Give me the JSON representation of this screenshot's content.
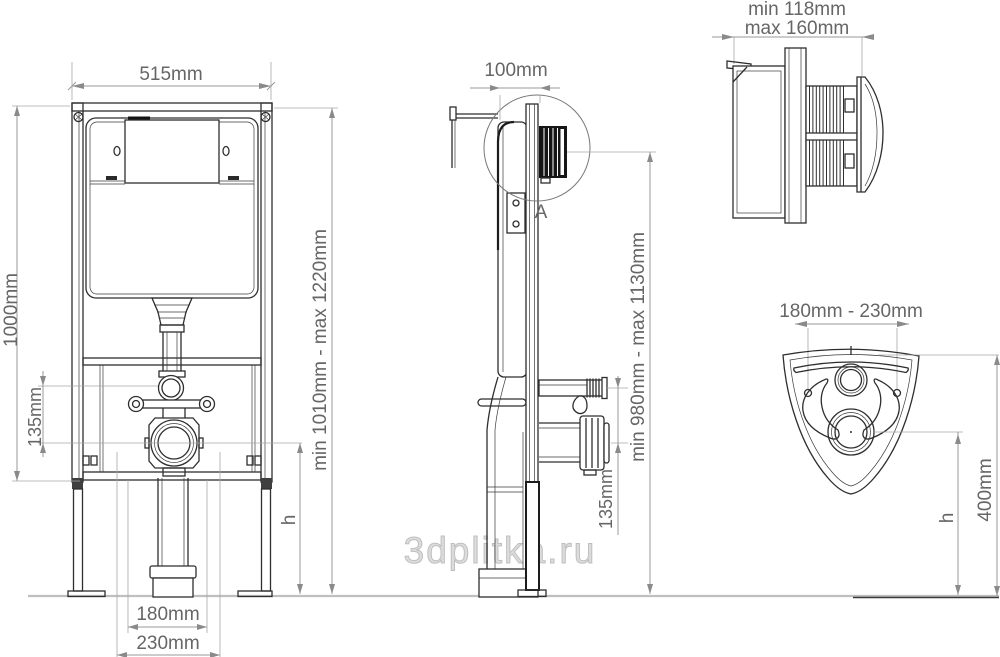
{
  "watermark": {
    "text": "3dplitka.ru"
  },
  "front_view": {
    "width": "515mm",
    "frame_height": "1000mm",
    "inlet_outlet_offset": "135mm",
    "bolt_spacing_inner": "180mm",
    "bolt_spacing_outer": "230mm",
    "install_height_range": "min 1010mm - max 1220mm",
    "outlet_height": "h"
  },
  "side_view": {
    "depth": "100mm",
    "detail_marker": "A",
    "install_height_range": "min 980mm - max 1130mm",
    "inlet_outlet_offset": "135mm"
  },
  "detail_view": {
    "min_depth": "min 118mm",
    "max_depth": "max 160mm"
  },
  "plate_view": {
    "bolt_spacing_range": "180mm - 230mm",
    "plate_height": "400mm",
    "outlet_height": "h"
  }
}
